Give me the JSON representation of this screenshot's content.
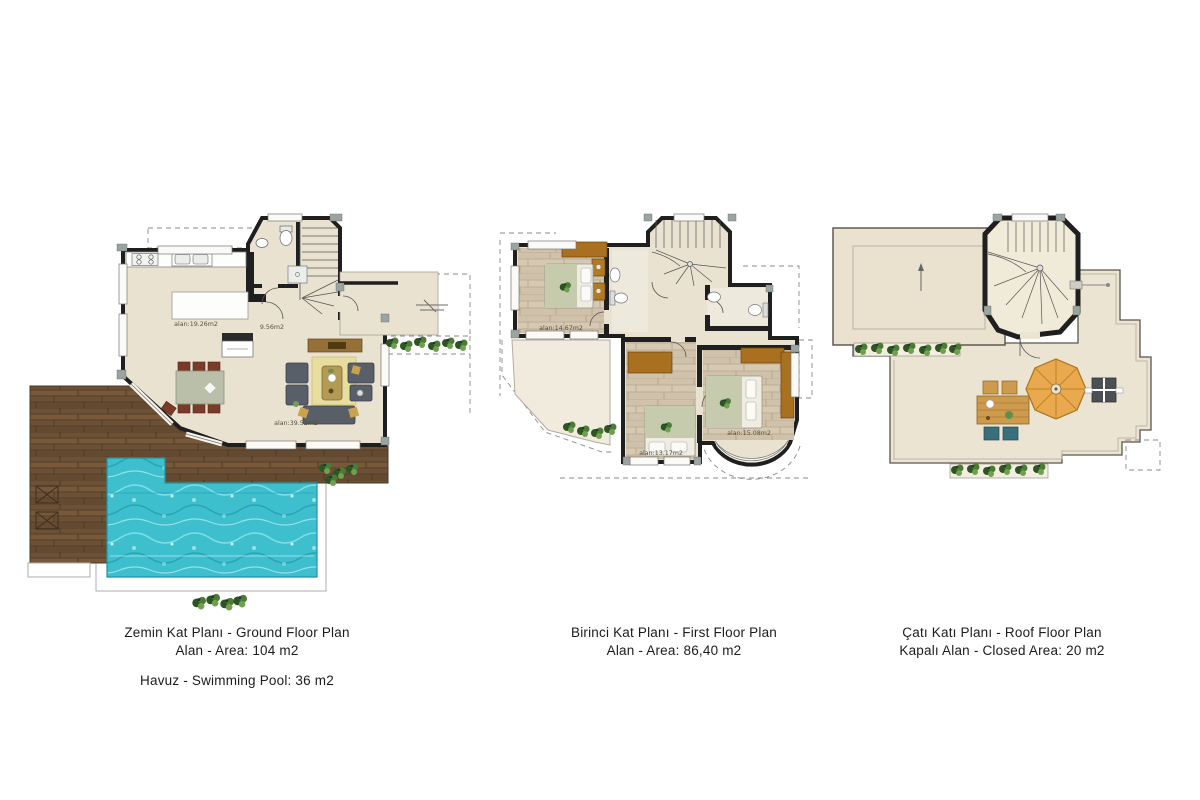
{
  "colors": {
    "wall": "#1f1f1f",
    "floor_beige": "#eae2d1",
    "floor_wood": "#cfc1aa",
    "deck_wood": "#6d5136",
    "pool_water": "#3ebfce",
    "furniture_wood": "#a9711f",
    "umbrella_orange": "#e9a94e",
    "plant_green": "#4a7d33",
    "sofa_gray": "#585f68",
    "rug_yellow": "#e7dd9e"
  },
  "ground_floor": {
    "area_labels": {
      "kitchen": "alan:19.26m2",
      "hall": "9.56m2",
      "living": "alan:39.52m2"
    },
    "caption_line1": "Zemin Kat Planı - Ground Floor Plan",
    "caption_line2": "Alan - Area: 104 m2",
    "caption_line3": "Havuz - Swimming Pool: 36 m2"
  },
  "first_floor": {
    "area_labels": {
      "bedroom1": "alan:14.67m2",
      "bedroom2": "alan:13.17m2",
      "bedroom3": "alan:15.08m2"
    },
    "caption_line1": "Birinci Kat Planı - First Floor Plan",
    "caption_line2": "Alan - Area: 86,40 m2"
  },
  "roof_floor": {
    "caption_line1": "Çatı Katı Planı - Roof Floor Plan",
    "caption_line2": "Kapalı Alan - Closed Area: 20 m2"
  }
}
